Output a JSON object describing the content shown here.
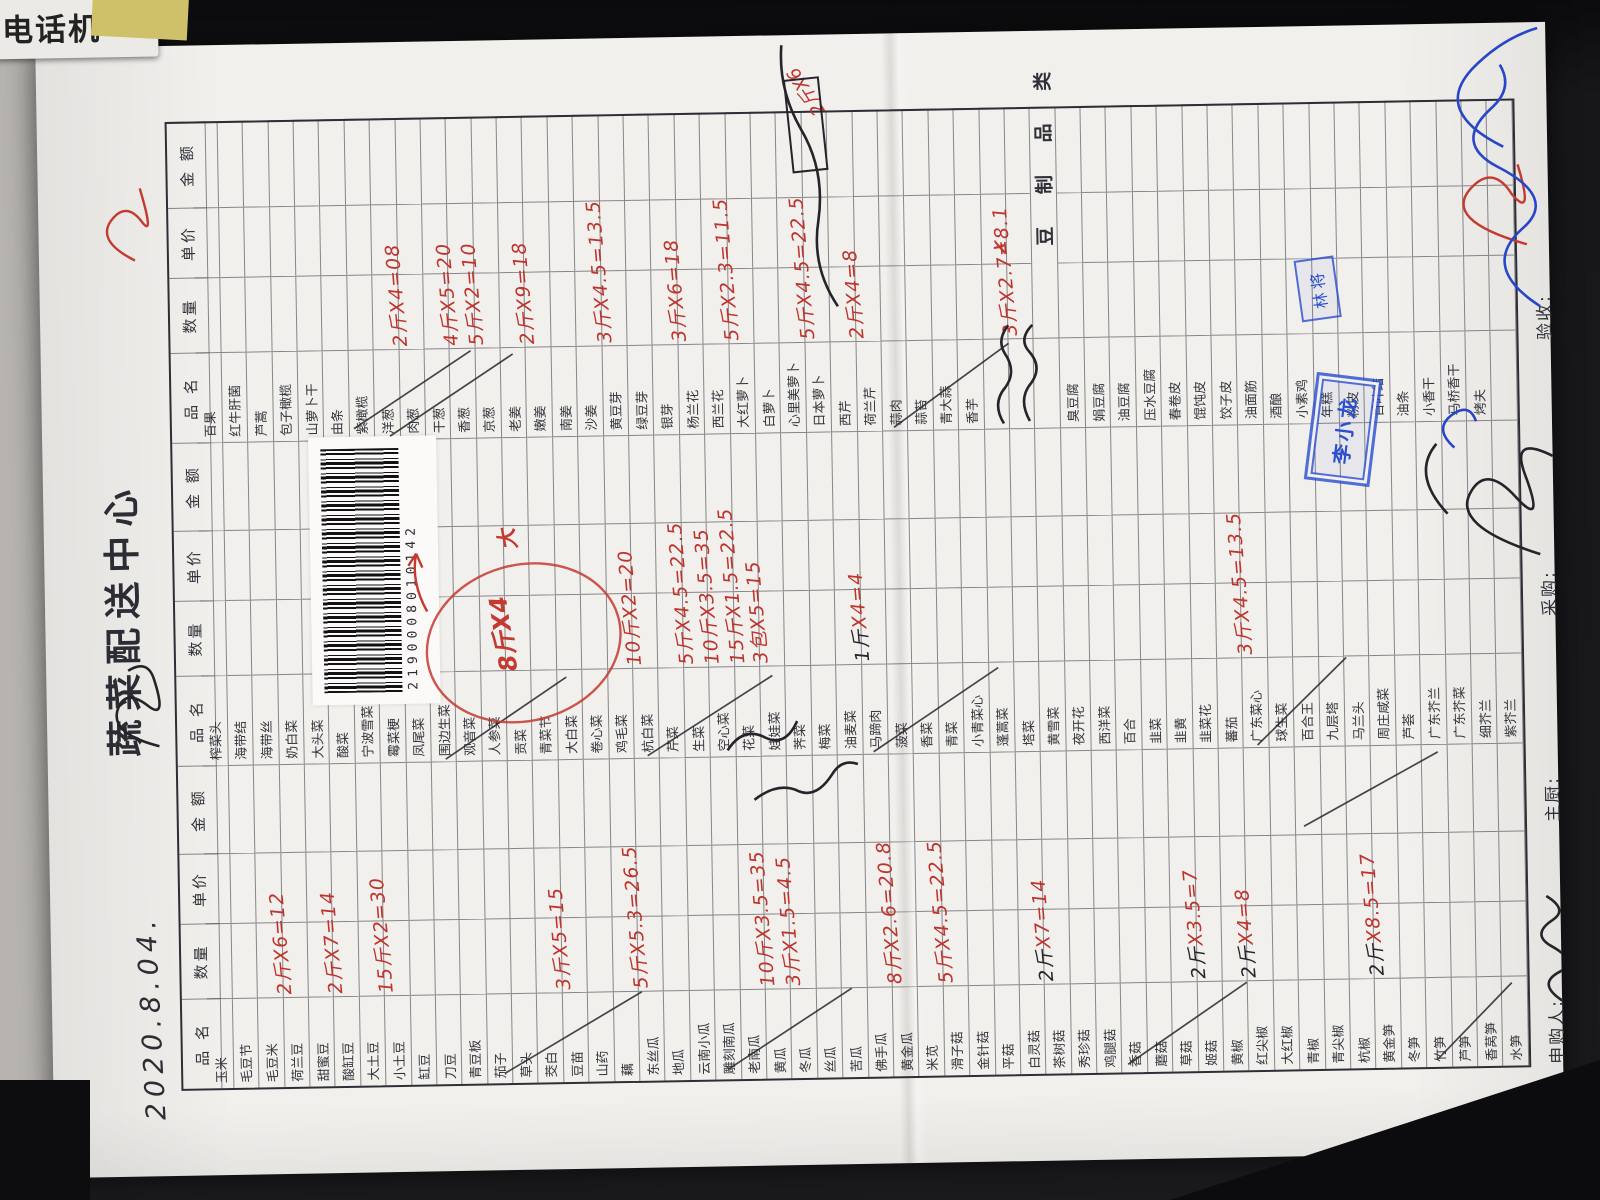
{
  "desk": {
    "label_text": "电话机"
  },
  "form": {
    "title": "蔬菜配送中心",
    "handwritten_date": "2020.8.04.",
    "barcode_digits": "2190008010142",
    "headers": {
      "name": "品 名",
      "qty": "数量",
      "price": "单价",
      "amount": "金 额"
    },
    "divider_label": "豆 制 品 类",
    "footer": {
      "shengou": "申购人:",
      "zhuchu": "主厨:",
      "caigou": "采购:",
      "yanshou": "验收:"
    },
    "stamps": {
      "small": "林将",
      "large": "李小龙"
    },
    "margin_note_red": "2斤X6",
    "circle_note_qty": "8斤X4",
    "circle_note_da": "大",
    "red_x_mark": "✗",
    "row_legend": "each row: [printed name, handwritten qty, handwritten priceXamount, ink r=red b=black-qty] ; ~scr~ = black scribbled cell ; ~div~ = section divider row",
    "groups": [
      {
        "rows": [
          [
            "玉米"
          ],
          [
            "毛豆节"
          ],
          [
            "毛豆米",
            "2斤",
            "X6=12",
            "r"
          ],
          [
            "荷兰豆"
          ],
          [
            "甜蜜豆",
            "2斤",
            "X7=14",
            "r"
          ],
          [
            "酸缸豆"
          ],
          [
            "大土豆",
            "15斤",
            "X2=30",
            "r"
          ],
          [
            "小土豆"
          ],
          [
            "缸豆"
          ],
          [
            "刀豆"
          ],
          [
            "青豆板"
          ],
          [
            "茄子"
          ],
          [
            "草头"
          ],
          [
            "茭白",
            "3斤",
            "X5=15",
            "r"
          ],
          [
            "豆苗"
          ],
          [
            "山药"
          ],
          [
            "藕",
            "5斤",
            "X5.3=26.5",
            "r"
          ],
          [
            "东丝瓜"
          ],
          [
            "地瓜"
          ],
          [
            "云南小瓜"
          ],
          [
            "雕刻南瓜"
          ],
          [
            "老南瓜",
            "10斤",
            "X3.5=35",
            "r"
          ],
          [
            "黄瓜",
            "3斤",
            "X1.5=4.5",
            "r"
          ],
          [
            "冬瓜"
          ],
          [
            "丝瓜"
          ],
          [
            "苦瓜"
          ],
          [
            "佛手瓜",
            "8斤",
            "X2.6=20.8",
            "r"
          ],
          [
            "黄金瓜"
          ],
          [
            "米苋",
            "5斤",
            "X4.5=22.5",
            "r"
          ],
          [
            "滑子菇"
          ],
          [
            "金针菇"
          ],
          [
            "平菇"
          ],
          [
            "白灵菇",
            "2斤",
            "X7=14",
            "b"
          ],
          [
            "茶树菇"
          ],
          [
            "秀珍菇"
          ],
          [
            "鸡腿菇"
          ],
          [
            "香菇"
          ],
          [
            "蘑菇"
          ],
          [
            "草菇",
            "2斤",
            "X3.5=7",
            "b"
          ],
          [
            "姬菇"
          ],
          [
            "黄椒",
            "2斤",
            "X4=8",
            "b"
          ],
          [
            "红尖椒"
          ],
          [
            "大红椒"
          ],
          [
            "青椒"
          ],
          [
            "青尖椒"
          ],
          [
            "杭椒",
            "2斤",
            "X8.5=17",
            "b"
          ],
          [
            "黄金笋"
          ],
          [
            "冬笋"
          ],
          [
            "竹笋"
          ],
          [
            "芦笋"
          ],
          [
            "香莴笋"
          ],
          [
            "水笋"
          ]
        ]
      },
      {
        "rows": [
          [
            "榨菜头"
          ],
          [
            "海带结"
          ],
          [
            "海带丝"
          ],
          [
            "奶白菜"
          ],
          [
            "大头菜"
          ],
          [
            "酸菜"
          ],
          [
            "宁波雪菜"
          ],
          [
            "霉菜梗"
          ],
          [
            "凤尾菜"
          ],
          [
            "围边生菜"
          ],
          [
            "观音菜"
          ],
          [
            "人参菜"
          ],
          [
            "贡菜"
          ],
          [
            "青菜节"
          ],
          [
            "大白菜"
          ],
          [
            "卷心菜"
          ],
          [
            "鸡毛菜",
            "10斤",
            "X2=20",
            "r"
          ],
          [
            "杭白菜"
          ],
          [
            "芹菜",
            "5斤",
            "X4.5=22.5",
            "r"
          ],
          [
            "生菜",
            "10斤",
            "X3.5=35",
            "r"
          ],
          [
            "空心菜",
            "15斤",
            "X1.5=22.5",
            "r"
          ],
          [
            "花菜",
            "3包",
            "X5=15",
            "r"
          ],
          [
            "娃娃菜"
          ],
          [
            "荠菜"
          ],
          [
            "梅菜"
          ],
          [
            "油麦菜",
            "1斤",
            "X4=4",
            "b"
          ],
          [
            "马蹄肉"
          ],
          [
            "菠菜"
          ],
          [
            "香菜"
          ],
          [
            "青菜"
          ],
          [
            "小青菜心"
          ],
          [
            "蓬蒿菜"
          ],
          [
            "塔菜"
          ],
          [
            "黄雪菜"
          ],
          [
            "夜开花"
          ],
          [
            "西洋菜"
          ],
          [
            "百合"
          ],
          [
            "韭菜"
          ],
          [
            "韭黄"
          ],
          [
            "韭菜花"
          ],
          [
            "蕃茄",
            "3斤",
            "X4.5=13.5",
            "r"
          ],
          [
            "广东菜心"
          ],
          [
            "球生菜"
          ],
          [
            "百合王"
          ],
          [
            "九层塔"
          ],
          [
            "马兰头"
          ],
          [
            "周庄咸菜"
          ],
          [
            "芦荟"
          ],
          [
            "广东芥兰"
          ],
          [
            "广东芥菜"
          ],
          [
            "细芥兰"
          ],
          [
            "紫芥兰"
          ]
        ]
      },
      {
        "rows": [
          [
            "百果"
          ],
          [
            "红牛肝菌"
          ],
          [
            "芦蒿"
          ],
          [
            "包子橄榄"
          ],
          [
            "山萝卜干"
          ],
          [
            "由条"
          ],
          [
            "紫橄榄"
          ],
          [
            "洋葱",
            "2斤",
            "X4=08",
            "r"
          ],
          [
            "肉葱"
          ],
          [
            "干葱",
            "4斤",
            "X5=20",
            "r"
          ],
          [
            "香葱",
            "5斤",
            "X2=10",
            "r"
          ],
          [
            "京葱"
          ],
          [
            "老姜",
            "2斤",
            "X9=18",
            "r"
          ],
          [
            "嫩姜"
          ],
          [
            "南姜"
          ],
          [
            "沙姜",
            "3斤",
            "X4.5=13.5",
            "r"
          ],
          [
            "黄豆芽"
          ],
          [
            "绿豆芽"
          ],
          [
            "银芽",
            "3斤",
            "X6=18",
            "r"
          ],
          [
            "杨兰花"
          ],
          [
            "西兰花",
            "5斤",
            "X2.3=11.5",
            "r"
          ],
          [
            "大红萝卜"
          ],
          [
            "白萝卜"
          ],
          [
            "心里美萝卜",
            "5斤",
            "X4.5=22.5",
            "r"
          ],
          [
            "日本萝卜"
          ],
          [
            "西芹",
            "2斤",
            "X4=8",
            "r"
          ],
          [
            "荷兰芹"
          ],
          [
            "蒜肉"
          ],
          [
            "蒜苔"
          ],
          [
            "青大蒜"
          ],
          [
            "香芋"
          ],
          [
            "~scr~",
            "3斤",
            "X2.7=8.1",
            "r"
          ],
          [
            "~scr~"
          ],
          [
            "~div~"
          ],
          [
            "臭豆腐"
          ],
          [
            "娟豆腐"
          ],
          [
            "油豆腐"
          ],
          [
            "压水豆腐"
          ],
          [
            "春卷皮"
          ],
          [
            "馄饨皮"
          ],
          [
            "饺子皮"
          ],
          [
            "油面筋"
          ],
          [
            "酒酿"
          ],
          [
            "小素鸡"
          ],
          [
            "年糕"
          ],
          [
            "粉皮"
          ],
          [
            "百叶结"
          ],
          [
            "油条"
          ],
          [
            "小香干"
          ],
          [
            "马桥香干"
          ],
          [
            "烤夫"
          ],
          [
            ""
          ]
        ]
      }
    ]
  }
}
